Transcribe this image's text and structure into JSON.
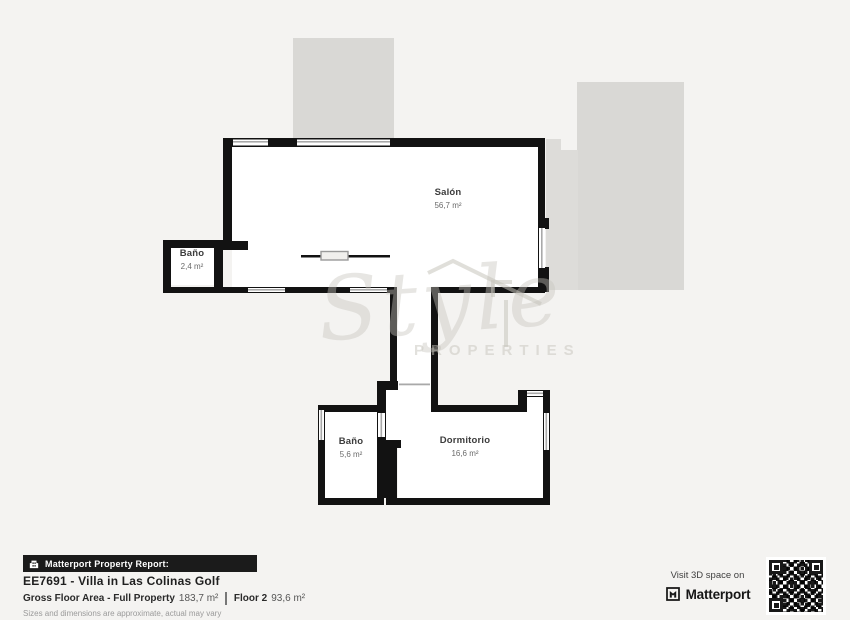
{
  "plan": {
    "rooms": [
      {
        "name": "Salón",
        "area": "56,7 m²"
      },
      {
        "name": "Baño",
        "area": "2,4 m²"
      },
      {
        "name": "Baño",
        "area": "5,6 m²"
      },
      {
        "name": "Dormitorio",
        "area": "16,6 m²"
      }
    ],
    "watermark": {
      "script": "Style",
      "caps": "PROPERTIES"
    }
  },
  "footer": {
    "badge_label": "Matterport Property Report:",
    "title": "EE7691 - Villa in Las Colinas Golf",
    "gross_label": "Gross Floor Area - Full Property",
    "gross_value": "183,7 m²",
    "floor_label": "Floor 2",
    "floor_value": "93,6 m²",
    "disclaimer": "Sizes and dimensions are approximate, actual may vary",
    "visit_text": "Visit 3D space on",
    "brand": "Matterport"
  },
  "icons": [
    "building-icon",
    "matterport-logo-icon",
    "qr-code"
  ],
  "colors": {
    "background": "#f4f3f1",
    "terrace_gray": "#d9d8d5",
    "terrace_gray_light": "#dddcd9",
    "wall": "#121212",
    "room_fill": "#ffffff",
    "window_line": "#a9a9a9",
    "badge_bg": "#1b1b1b",
    "text_dark": "#1f1f1f",
    "text_gray": "#9a9a9a"
  }
}
